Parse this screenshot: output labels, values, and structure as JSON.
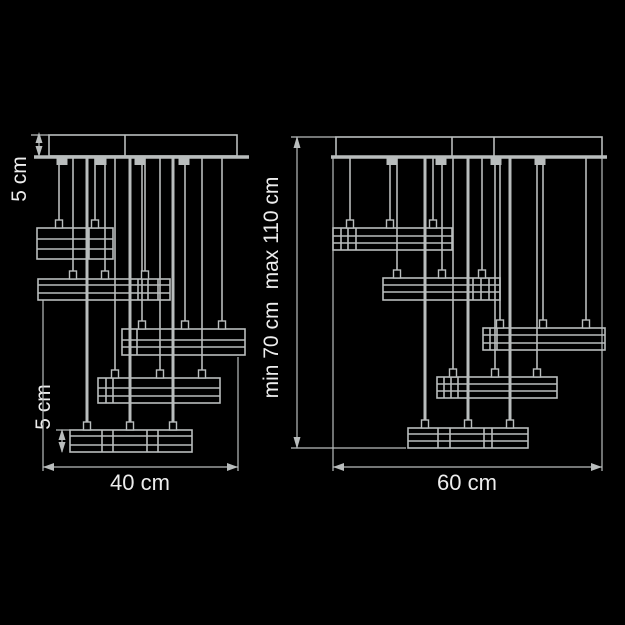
{
  "colors": {
    "background": "#000000",
    "line": "#b9bdbd",
    "text": "#ededed"
  },
  "left_diagram": {
    "canopy_height_label": "5 cm",
    "lamp_bar_height_label": "5 cm",
    "width_label": "40 cm"
  },
  "right_diagram": {
    "max_height_label": "max 110 cm",
    "min_height_label": "min 70 cm",
    "width_label": "60 cm"
  }
}
